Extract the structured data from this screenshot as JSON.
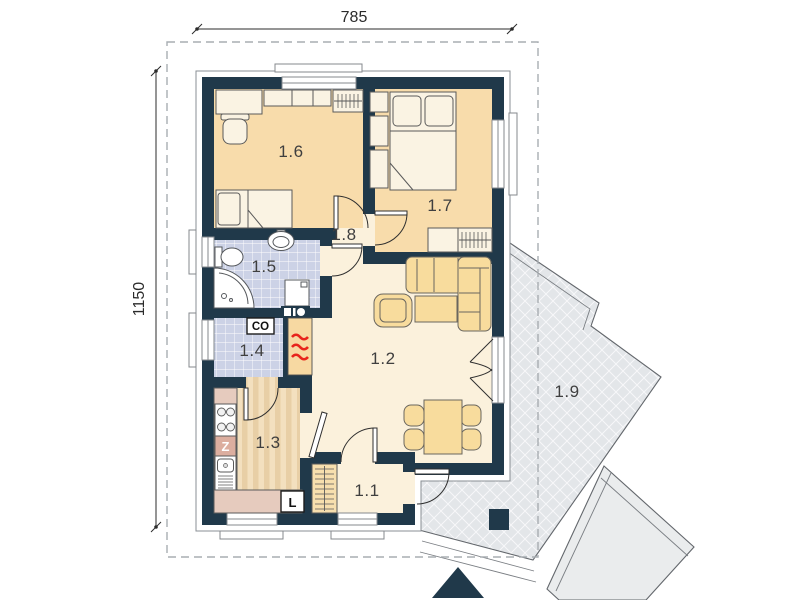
{
  "plan": {
    "dimensions": {
      "top": "785",
      "side": "1150"
    },
    "rooms": [
      "1.1",
      "1.2",
      "1.3",
      "1.4",
      "1.5",
      "1.6",
      "1.7",
      "1.8",
      "1.9"
    ],
    "markers": {
      "central_heating": "CO",
      "fridge": "L",
      "sink_block": "Z"
    }
  },
  "colors": {
    "wall": "#20394a",
    "bedroom_floor": "#f8dcab",
    "living_floor": "#fbf1dc",
    "tile_floor": "#ccd2e6",
    "kitchen_floor": "#f3e0bf",
    "kitchen_stripe": "#e8cfa6",
    "counter": "#e6cbbe",
    "sink_block": "#dcae9f",
    "furniture": "#faf3e3",
    "upholstery": "#f8dc9d",
    "terrace": "#e3e6e9",
    "terrace_lower": "#eaeced",
    "fireplace_red": "#e8251c"
  }
}
